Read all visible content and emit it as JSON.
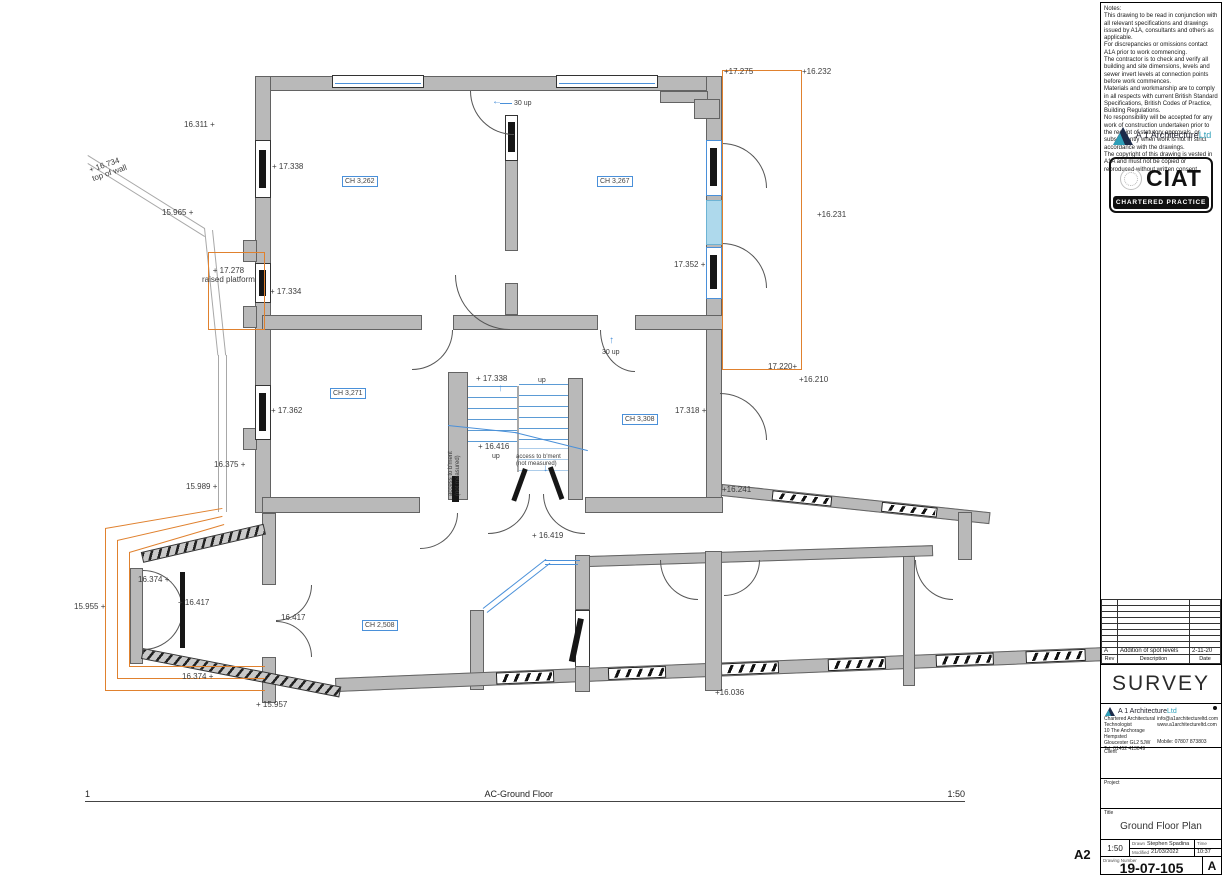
{
  "sheet": {
    "size": "A2"
  },
  "notes": {
    "text": "Notes:\nThis drawing to be read in conjunction with all relevant specifications and drawings issued by A1A, consultants and others as applicable.\nFor discrepancies or omissions contact A1A prior to work commencing.\nThe contractor is to check and verify all building and site dimensions, levels and sewer invert levels at connection points before work commences.\nMaterials and workmanship are to comply in all respects with current British Standard Specifications, British Codes of Practice, Building Regulations.\nNo responsibility will be accepted for any work of construction undertaken prior to the receipt of statutory approvals, or subsequently when work is not in strict accordance with the drawings.\nThe copyright of this drawing is vested in A1A and must not be copied or reproduced without written consent."
  },
  "brand": {
    "name": "A 1 Architecture",
    "suffix": "Ltd"
  },
  "ciat": {
    "acronym": "CIAT",
    "caption": "CHARTERED PRACTICE"
  },
  "revisions": {
    "header": {
      "rev": "Rev",
      "description": "Description",
      "date": "Date"
    },
    "rows": [
      {
        "rev": "A",
        "description": "Addition of spot levels",
        "date": "2-11-20"
      }
    ]
  },
  "status": {
    "label": "SURVEY"
  },
  "contact": {
    "role": "Chartered Architectural Technologist",
    "addr1": "10 The Anchorage",
    "addr2": "Hempsted",
    "addr3": "Gloucester GL2 5JW",
    "tel": "Tel: 01452 413049",
    "email": "info@a1architectureltd.com",
    "web": "www.a1architectureltd.com",
    "mobile": "Mobile: 07807 873803",
    "client_label": "Client",
    "project_label": "Project"
  },
  "title_block": {
    "title_label": "Title",
    "title": "Ground Floor Plan",
    "scale": "1:50",
    "drawn_label": "Drawn",
    "drawn": "Stephen Spadina",
    "modified_label": "Modified",
    "modified_date": "21/03/2022",
    "time_label": "Time",
    "time": "10:37",
    "number_label": "Drawing Number",
    "number": "19-07-105",
    "revision": "A"
  },
  "plan": {
    "view": {
      "number": "1",
      "name": "AC-Ground Floor",
      "scale": "1:50"
    },
    "rooms": {
      "r1": "CH 3,262",
      "r2": "CH 3,267",
      "r3": "CH 3,271",
      "r4": "CH 3,308",
      "r5": "CH 2,508"
    },
    "stairs": {
      "up": "up",
      "up2": "up",
      "thirty_top": "30 up",
      "thirty_mid": "30 up",
      "access1": "access to b'ment",
      "access1b": "(not measured)",
      "access2": "access to b'ment",
      "access2b": "(not measured)"
    },
    "levels": {
      "l16311": "16.311 +",
      "l16734": "+ 16.734",
      "top_of_wall": "top of wall",
      "l15965": "15.965 +",
      "l17338_room": "+ 17.338",
      "l17275": "+17.275",
      "l16232": "+16.232",
      "l16231": "+16.231",
      "l17352": "17.352 +",
      "l17278": "+ 17.278",
      "raised_platform": "raised platform",
      "l17334": "+ 17.334",
      "l17220": "17.220+",
      "l16210": "+16.210",
      "l17338_stair": "+ 17.338",
      "l17362": "+ 17.362",
      "l17318": "17.318 +",
      "l16416": "+ 16.416",
      "l16375": "16.375 +",
      "l15989": "15.989 +",
      "l16241": "+16.241",
      "l16419": "+ 16.419",
      "l16374_a": "16.374 +",
      "l15955": "15.955 +",
      "l16417_a": "+ 16.417",
      "l16417_b": "16.417",
      "l16374_b": "16.374 +",
      "l15957": "+ 15.957",
      "l16036": "+16.036"
    },
    "colors": {
      "wall": "#b9b9b9",
      "annotation_orange": "#e0812e",
      "stair_blue": "#4a90d9",
      "highlight_cyan": "#aed9ec"
    }
  }
}
